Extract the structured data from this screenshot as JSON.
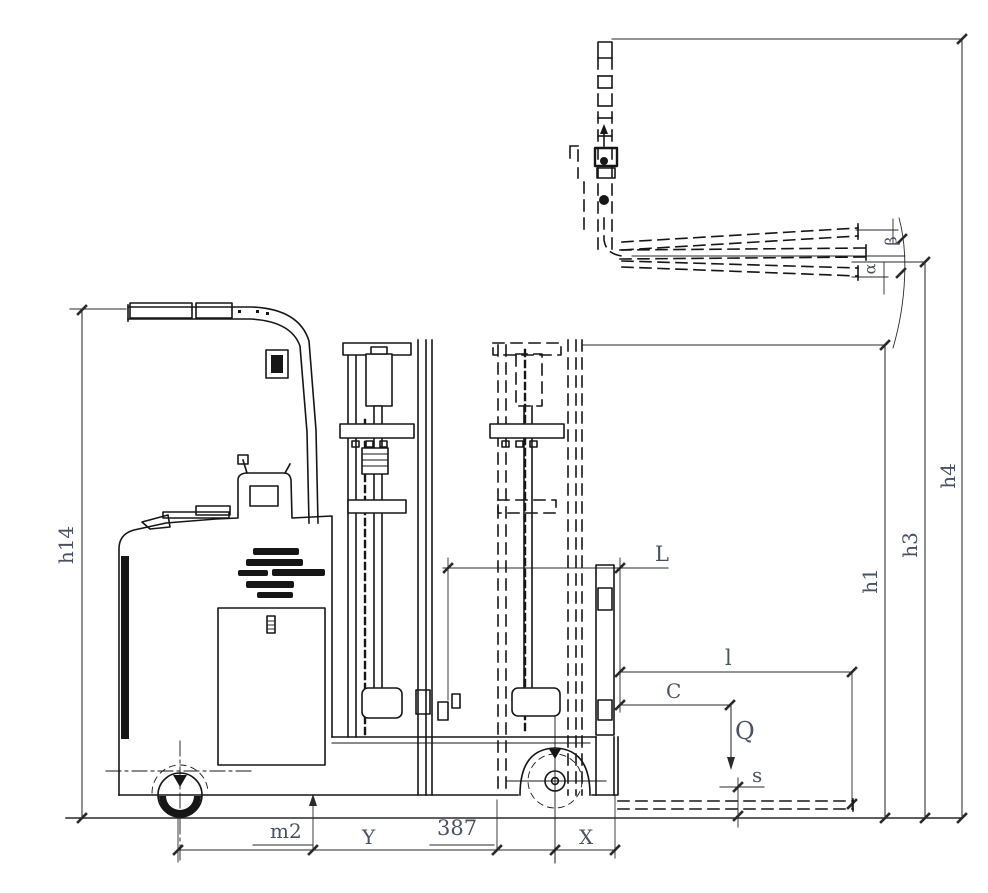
{
  "drawing": {
    "type": "engineering-dimension-diagram",
    "subject": "reach truck forklift side elevation with mast retracted, mast extended (dashed) and forks raised/tilted (dashed)",
    "background": "#ffffff",
    "line_color": "#161616",
    "dim_line_color": "#2a2a2a",
    "label_color": "#4a5160"
  },
  "labels": {
    "h14": "h14",
    "h1": "h1",
    "h3": "h3",
    "h4": "h4",
    "L": "L",
    "l": "l",
    "C": "C",
    "Q": "Q",
    "s": "s",
    "m2": "m2",
    "Y": "Y",
    "n387": "387",
    "X": "X",
    "beta": "β",
    "alpha": "α"
  }
}
